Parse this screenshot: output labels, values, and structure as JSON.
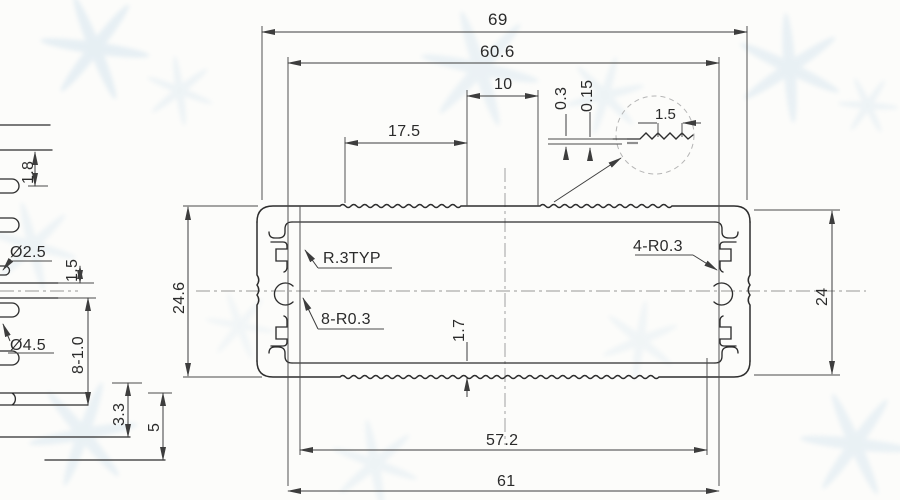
{
  "drawing": {
    "dims": {
      "overall_width": "69",
      "groove_span": "60.6",
      "flat_width": "10",
      "flat_offset": "17.5",
      "knurl_depth": "0.3",
      "knurl_half": "0.15",
      "knurl_pitch": "1.5",
      "height_overall": "24.6",
      "height_body": "24",
      "wall_thickness": "1.7",
      "inner_span": "57.2",
      "base_width": "61",
      "fillet_typ": "R.3TYP",
      "fillet_slots": "8-R0.3",
      "fillet_tabs": "4-R0.3"
    },
    "side_view": {
      "step": "1.8",
      "hole_small": "Ø2.5",
      "gap": "1.5",
      "hole_large": "Ø4.5",
      "hole_row": "8-1.0",
      "offset": "3.3",
      "edge_margin": "5"
    }
  }
}
